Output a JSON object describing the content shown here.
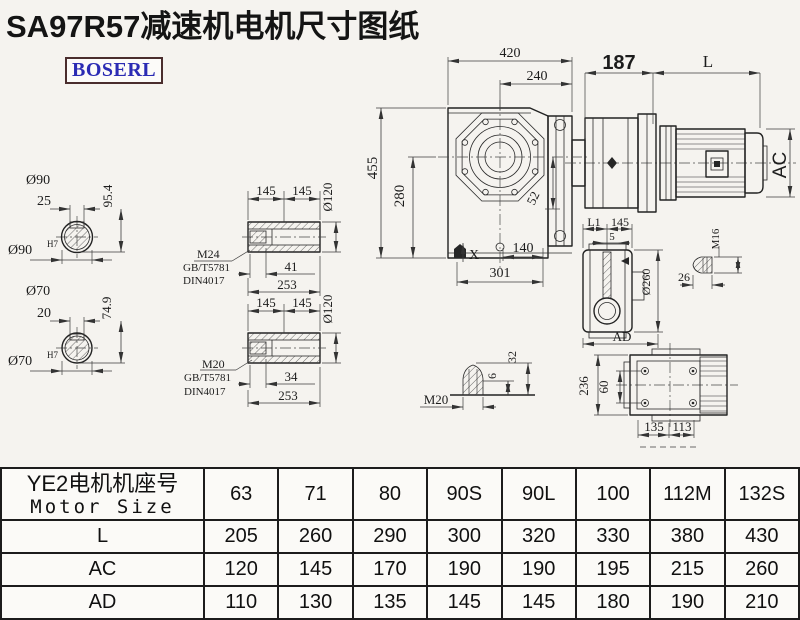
{
  "title": "SA97R57减速机电机尺寸图纸",
  "logo": {
    "text": "BOSERL"
  },
  "colors": {
    "title": "#141414",
    "logo_text": "#2b2bb4",
    "logo_border": "#4a2d2d",
    "line": "#2a2a2a",
    "background": "#f5f3ef"
  },
  "dims": {
    "width_420": "420",
    "width_240": "240",
    "motor_187": "187",
    "motor_L": "L",
    "motor_AC": "AC",
    "height_455": "455",
    "height_280": "280",
    "drop_52": "52",
    "mark_X": "X",
    "foot_140": "140",
    "foot_301": "301",
    "shaft90_dia": "Ø90",
    "shaft90_key": "25",
    "shaft90_kh": "95.4",
    "shaft90_fit": "Ø90",
    "shaft90_fit_sup": "H7",
    "shaft70_dia": "Ø70",
    "shaft70_key": "20",
    "shaft70_kh": "74.9",
    "shaft70_fit": "Ø70",
    "shaft70_fit_sup": "H7",
    "hub1_seg1": "145",
    "hub1_seg2": "145",
    "hub1_od": "Ø120",
    "hub1_bolt": "M24",
    "hub1_std1": "GB/T5781",
    "hub1_std2": "DIN4017",
    "hub1_depth": "41",
    "hub1_len": "253",
    "hub2_seg1": "145",
    "hub2_seg2": "145",
    "hub2_od": "Ø120",
    "hub2_bolt": "M20",
    "hub2_std1": "GB/T5781",
    "hub2_std2": "DIN4017",
    "hub2_depth": "34",
    "hub2_len": "253",
    "side_L1": "L1",
    "side_145": "145",
    "side_5": "5",
    "side_od": "Ø260",
    "side_AD": "AD",
    "side_M16": "M16",
    "side_26": "26",
    "bolt_M20": "M20",
    "bolt_6": "6",
    "bolt_32": "32",
    "tv_236": "236",
    "tv_60": "60",
    "tv_135": "135",
    "tv_113": "113"
  },
  "table": {
    "header": {
      "cn": "YE2电机机座号",
      "en": "Motor Size"
    },
    "sizes": [
      "63",
      "71",
      "80",
      "90S",
      "90L",
      "100",
      "112M",
      "132S"
    ],
    "rows": [
      {
        "label": "L",
        "values": [
          "205",
          "260",
          "290",
          "300",
          "320",
          "330",
          "380",
          "430"
        ]
      },
      {
        "label": "AC",
        "values": [
          "120",
          "145",
          "170",
          "190",
          "190",
          "195",
          "215",
          "260"
        ]
      },
      {
        "label": "AD",
        "values": [
          "110",
          "130",
          "135",
          "145",
          "145",
          "180",
          "190",
          "210"
        ]
      }
    ]
  }
}
